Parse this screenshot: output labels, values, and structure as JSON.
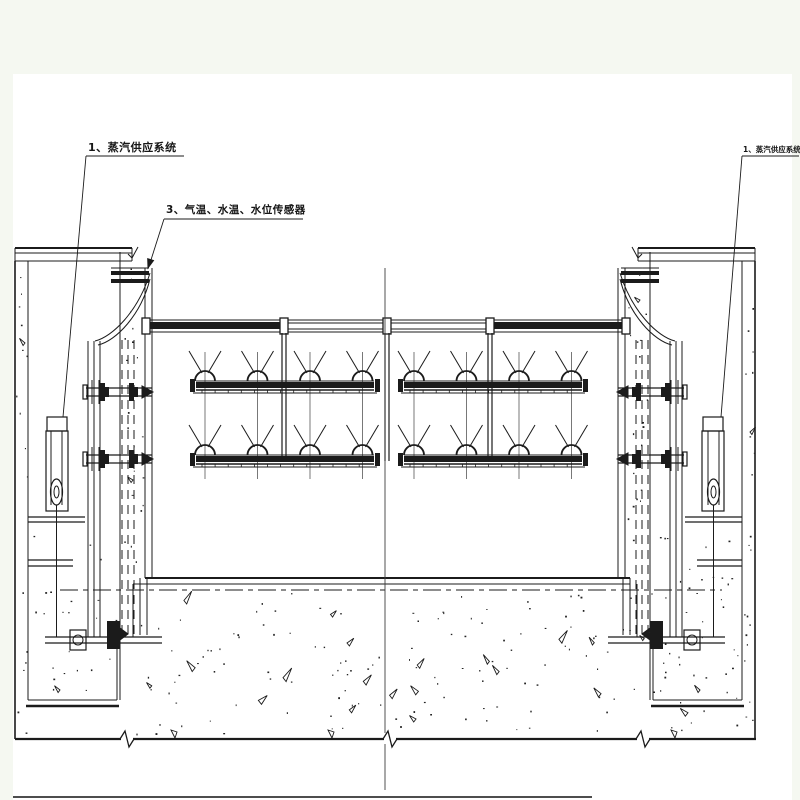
{
  "page": {
    "background_color": "#f5f8f1",
    "paper_color": "#ffffff",
    "ink_color": "#1b1b1b"
  },
  "annotations": {
    "left_steam_label": "1、蒸汽供应系统",
    "sensor_label": "3、气温、水温、水位传感器",
    "right_steam_label": "1、蒸汽供应系统"
  }
}
